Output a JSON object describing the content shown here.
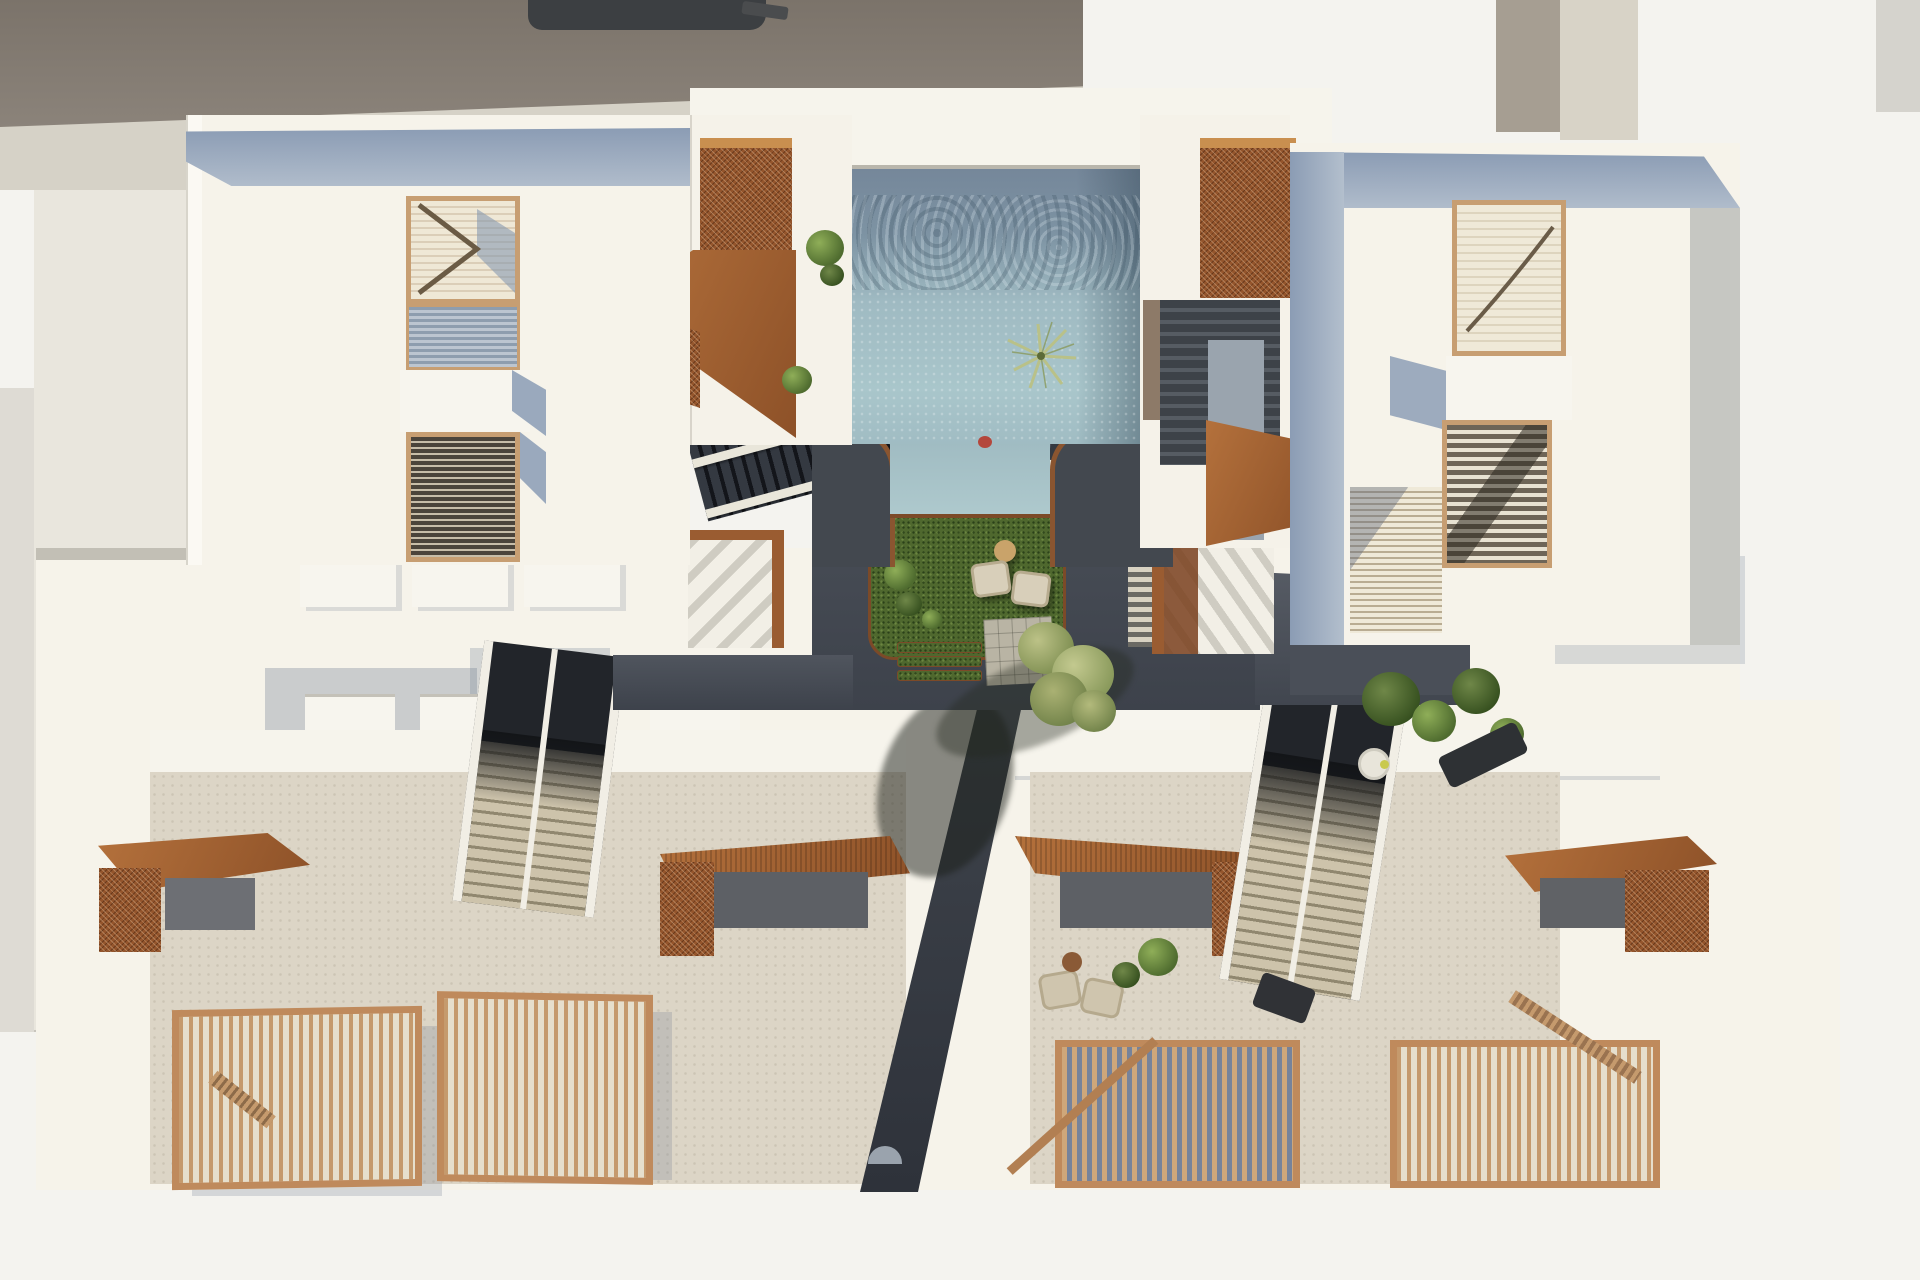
{
  "scene": {
    "title": "aerial-architectural-render",
    "setting": "top-down view of a white residential complex with central pool courtyard",
    "areas": {
      "neighbor_roof": "dark taupe flat roof strip, top-left",
      "upper_left_building": "cream roof with timber-framed louver skylights and balcony",
      "upper_right_building": "cream roof with timber-framed louver skylights",
      "pool_court": "rectangular pool, water channel, sunken lawn with lounge chairs and olive tree",
      "stair_cores": "corten-steel mesh canopies and double stair flights flanking the pool",
      "mid_level": "two escalator-like stair flights descending to lower terraces",
      "lower_buildings": "two lower volumes with corten entrance canopies, stone terraces, timber slat railings and a dark central alley"
    },
    "objects": [
      "pool",
      "water-channel",
      "lawn",
      "lounge-chair",
      "side-table",
      "olive-tree",
      "palm-plant",
      "corten-canopy",
      "corten-mesh-balcony",
      "louver-skylight",
      "escalator-stair",
      "upper-stair",
      "pergola-stair",
      "timber-railing",
      "timber-deck",
      "stepping-tiles",
      "sun-lounger",
      "shrub",
      "alley"
    ]
  },
  "palette": {
    "background": "#f4f3ef",
    "neighbor_roof": "#857d74",
    "facade_cream": "#f6f3ea",
    "parapet_blue": "#93a2b8",
    "corten_rust": "#9a5a2f",
    "timber_tan": "#c79e72",
    "pool_deep": "#76889a",
    "pool_shallow": "#a9c6cb",
    "courtyard_charcoal": "#474c55",
    "grass_green": "#4f682e",
    "terrace_stone": "#dcd5c6",
    "stair_dark": "#24272b",
    "stair_beige": "#cdc3ab",
    "foliage_olive": "#9aa566",
    "shadow_blue": "rgba(118,130,150,0.34)"
  }
}
